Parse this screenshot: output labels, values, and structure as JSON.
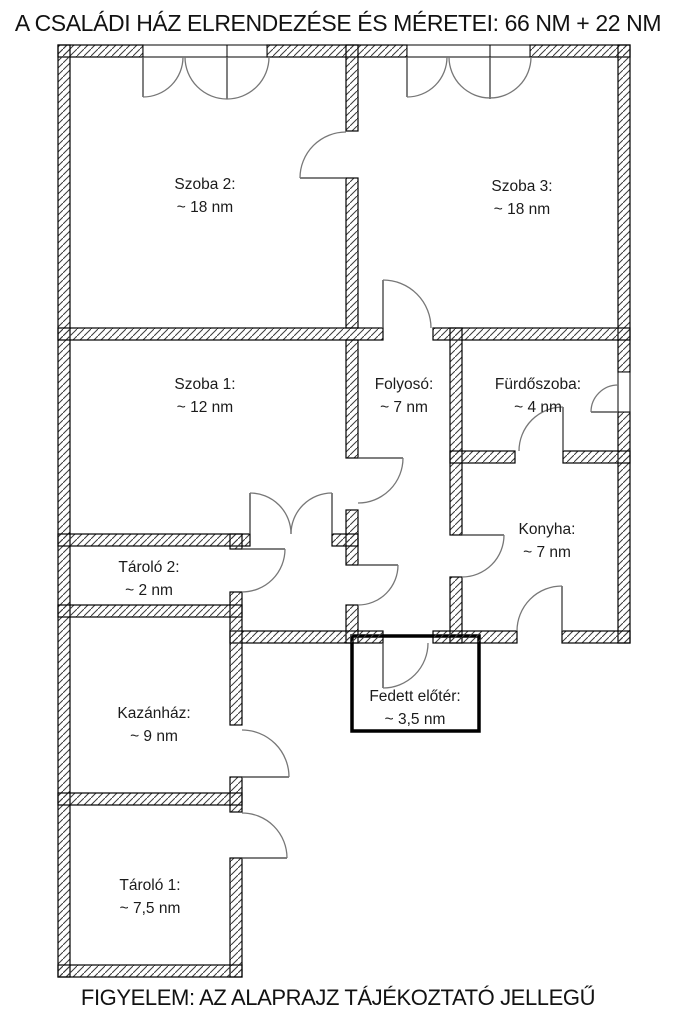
{
  "title": "A CSALÁDI HÁZ ELRENDEZÉSE ÉS MÉRETEI: 66 NM + 22 NM",
  "footer": "FIGYELEM: AZ ALAPRAJZ TÁJÉKOZTATÓ JELLEGŰ",
  "colors": {
    "wall_outline": "#000000",
    "hatch_line": "#3a3a3a",
    "door_arc": "#777777",
    "door_leaf": "#555555",
    "background": "#ffffff",
    "text": "#1b1b1b"
  },
  "rooms": [
    {
      "id": "szoba-2",
      "name": "Szoba 2:",
      "size": "~ 18 nm"
    },
    {
      "id": "szoba-3",
      "name": "Szoba 3:",
      "size": "~ 18 nm"
    },
    {
      "id": "szoba-1",
      "name": "Szoba 1:",
      "size": "~ 12 nm"
    },
    {
      "id": "folyoso",
      "name": "Folyosó:",
      "size": "~ 7 nm"
    },
    {
      "id": "furdoszoba",
      "name": "Fürdőszoba:",
      "size": "~ 4 nm"
    },
    {
      "id": "konyha",
      "name": "Konyha:",
      "size": "~ 7 nm"
    },
    {
      "id": "tarolo-2",
      "name": "Tároló 2:",
      "size": "~ 2 nm"
    },
    {
      "id": "kazanhaz",
      "name": "Kazánház:",
      "size": "~ 9 nm"
    },
    {
      "id": "tarolo-1",
      "name": "Tároló 1:",
      "size": "~ 7,5 nm"
    },
    {
      "id": "fedett-eloter",
      "name": "Fedett előtér:",
      "size": "~ 3,5 nm"
    }
  ]
}
